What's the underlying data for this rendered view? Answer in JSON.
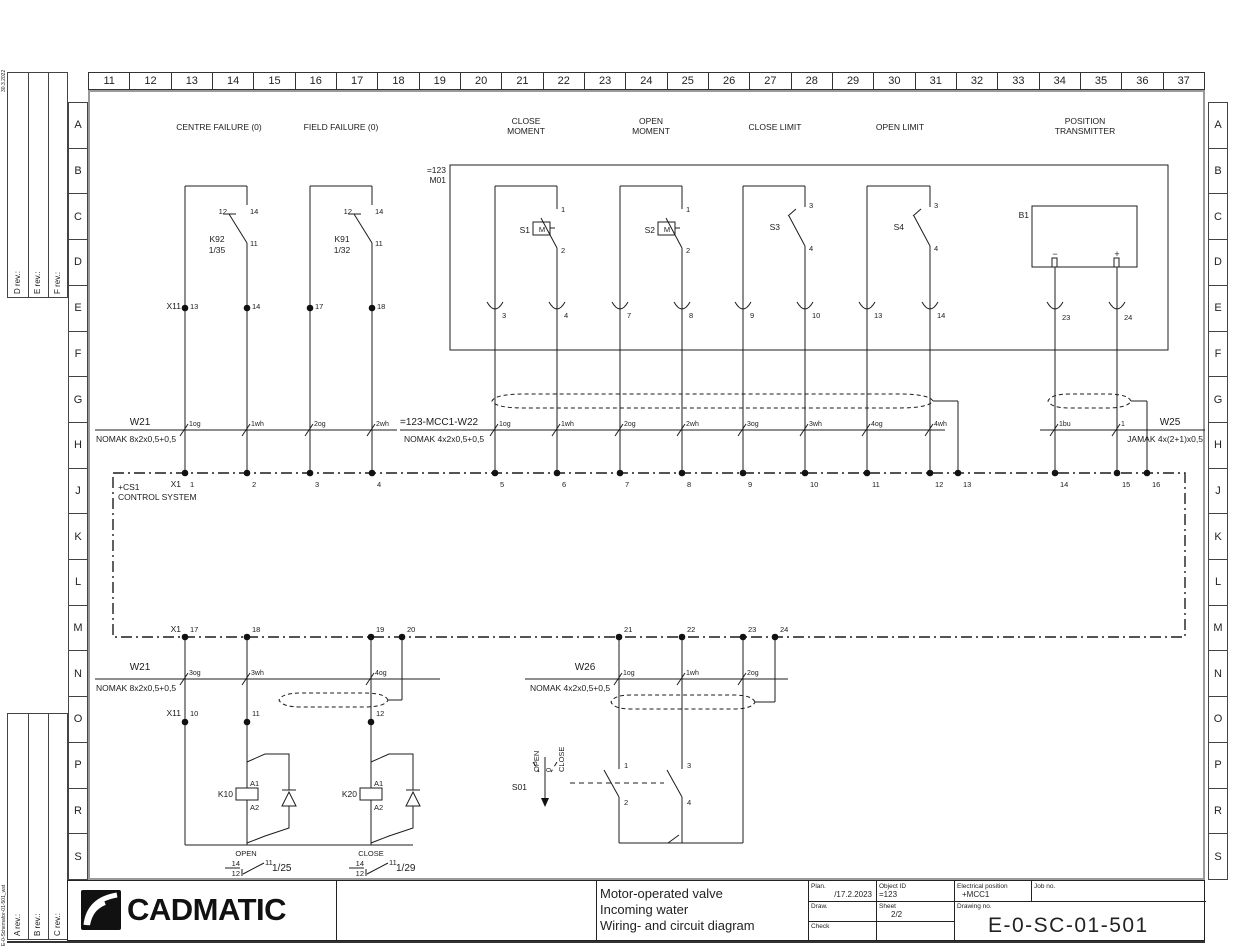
{
  "frame": {
    "ruler_numbers": [
      "11",
      "12",
      "13",
      "14",
      "15",
      "16",
      "17",
      "18",
      "19",
      "20",
      "21",
      "22",
      "23",
      "24",
      "25",
      "26",
      "27",
      "28",
      "29",
      "30",
      "31",
      "32",
      "33",
      "34",
      "35",
      "36",
      "37"
    ],
    "row_letters": [
      "A",
      "B",
      "C",
      "D",
      "E",
      "F",
      "G",
      "H",
      "J",
      "K",
      "L",
      "M",
      "N",
      "O",
      "P",
      "R",
      "S"
    ],
    "rev_labels_top": [
      "D rev.:",
      "E rev.:",
      "F rev.:"
    ],
    "rev_labels_bottom": [
      "A rev.:",
      "B rev.:",
      "C rev.:"
    ],
    "edge_text_top": "30.3.2022",
    "edge_text_bottom": "E-0-Schemafor-01-501_wst"
  },
  "titleblock": {
    "logo_text": "CADMATIC",
    "description": [
      "Motor-operated valve",
      "Incoming water",
      "Wiring- and circuit diagram"
    ],
    "plan_label": "Plan.",
    "plan_value": "/17.2.2023",
    "object_id_label": "Object ID",
    "object_id_value": "=123",
    "elec_pos_label": "Electrical position",
    "elec_pos_value": "+MCC1",
    "job_no_label": "Job no.",
    "draw_label": "Draw.",
    "sheet_label": "Sheet",
    "sheet_value": "2/2",
    "check_label": "Check",
    "drawing_no_label": "Drawing no.",
    "drawing_no_value": "E-0-SC-01-501"
  },
  "geometry": {
    "top_terminals_x": [
      185,
      247,
      310,
      372,
      495,
      557,
      620,
      682,
      743,
      805,
      867,
      930,
      958,
      1055,
      1117,
      1147
    ],
    "top_terminals_y": 473,
    "x11_top_x": [
      185,
      247,
      310,
      372
    ],
    "x11_top_y": 308,
    "bottom_terminals_x": [
      185,
      247,
      371,
      402,
      619,
      682,
      743,
      775
    ],
    "bottom_terminals_y": 637,
    "x11_bottom_x": [
      185,
      247,
      371
    ],
    "x11_bottom_y": 722,
    "hooks_x": [
      495,
      557,
      620,
      682,
      743,
      805,
      867,
      930,
      1055,
      1117
    ],
    "upper_cross_x": [
      185,
      247,
      310,
      372,
      495,
      557,
      620,
      682,
      743,
      805,
      867,
      930,
      1055,
      1117
    ],
    "upper_cross_y": 430,
    "lower_cross_x": [
      185,
      247,
      371,
      619,
      682,
      743
    ],
    "lower_cross_y": 679
  },
  "annotations": [
    {
      "t": "CENTRE FAILURE (0)",
      "x": 219,
      "y": 130,
      "a": "m"
    },
    {
      "t": "FIELD FAILURE (0)",
      "x": 341,
      "y": 130,
      "a": "m"
    },
    {
      "t": "CLOSE",
      "x": 526,
      "y": 124,
      "a": "m"
    },
    {
      "t": "MOMENT",
      "x": 526,
      "y": 134,
      "a": "m"
    },
    {
      "t": "OPEN",
      "x": 651,
      "y": 124,
      "a": "m"
    },
    {
      "t": "MOMENT",
      "x": 651,
      "y": 134,
      "a": "m"
    },
    {
      "t": "CLOSE LIMIT",
      "x": 775,
      "y": 130,
      "a": "m"
    },
    {
      "t": "OPEN LIMIT",
      "x": 900,
      "y": 130,
      "a": "m"
    },
    {
      "t": "POSITION",
      "x": 1085,
      "y": 124,
      "a": "m"
    },
    {
      "t": "TRANSMITTER",
      "x": 1085,
      "y": 134,
      "a": "m"
    },
    {
      "t": "=123",
      "x": 446,
      "y": 173,
      "a": "e"
    },
    {
      "t": "M01",
      "x": 446,
      "y": 183,
      "a": "e"
    },
    {
      "t": "12",
      "x": 227,
      "y": 214,
      "a": "e",
      "s": 7.5
    },
    {
      "t": "14",
      "x": 250,
      "y": 214,
      "s": 7.5
    },
    {
      "t": "K92",
      "x": 217,
      "y": 242,
      "a": "m"
    },
    {
      "t": "1/35",
      "x": 217,
      "y": 253,
      "a": "m"
    },
    {
      "t": "11",
      "x": 250,
      "y": 246,
      "s": 7.5
    },
    {
      "t": "12",
      "x": 352,
      "y": 214,
      "a": "e",
      "s": 7.5
    },
    {
      "t": "14",
      "x": 375,
      "y": 214,
      "s": 7.5
    },
    {
      "t": "K91",
      "x": 342,
      "y": 242,
      "a": "m"
    },
    {
      "t": "1/32",
      "x": 342,
      "y": 253,
      "a": "m"
    },
    {
      "t": "11",
      "x": 375,
      "y": 246,
      "s": 7.5
    },
    {
      "t": "X11",
      "x": 181,
      "y": 309,
      "a": "e"
    },
    {
      "t": "13",
      "x": 190,
      "y": 309,
      "s": 7.5
    },
    {
      "t": "14",
      "x": 252,
      "y": 309,
      "s": 7.5
    },
    {
      "t": "17",
      "x": 315,
      "y": 309,
      "s": 7.5
    },
    {
      "t": "18",
      "x": 377,
      "y": 309,
      "s": 7.5
    },
    {
      "t": "S1",
      "x": 530,
      "y": 233,
      "a": "e"
    },
    {
      "t": "M",
      "x": 542,
      "y": 232,
      "a": "m",
      "s": 7.5
    },
    {
      "t": "1",
      "x": 561,
      "y": 212,
      "s": 7.5
    },
    {
      "t": "2",
      "x": 561,
      "y": 253,
      "s": 7.5
    },
    {
      "t": "S2",
      "x": 655,
      "y": 233,
      "a": "e"
    },
    {
      "t": "M",
      "x": 667,
      "y": 232,
      "a": "m",
      "s": 7.5
    },
    {
      "t": "1",
      "x": 686,
      "y": 212,
      "s": 7.5
    },
    {
      "t": "2",
      "x": 686,
      "y": 253,
      "s": 7.5
    },
    {
      "t": "S3",
      "x": 780,
      "y": 230,
      "a": "e"
    },
    {
      "t": "3",
      "x": 809,
      "y": 208,
      "s": 7.5
    },
    {
      "t": "4",
      "x": 809,
      "y": 251,
      "s": 7.5
    },
    {
      "t": "S4",
      "x": 904,
      "y": 230,
      "a": "e"
    },
    {
      "t": "3",
      "x": 934,
      "y": 208,
      "s": 7.5
    },
    {
      "t": "4",
      "x": 934,
      "y": 251,
      "s": 7.5
    },
    {
      "t": "B1",
      "x": 1029,
      "y": 218,
      "a": "e"
    },
    {
      "t": "−",
      "x": 1055,
      "y": 257,
      "a": "m",
      "s": 9
    },
    {
      "t": "+",
      "x": 1117,
      "y": 257,
      "a": "m",
      "s": 9
    },
    {
      "t": "3",
      "x": 502,
      "y": 318,
      "s": 7.5
    },
    {
      "t": "4",
      "x": 564,
      "y": 318,
      "s": 7.5
    },
    {
      "t": "7",
      "x": 627,
      "y": 318,
      "s": 7.5
    },
    {
      "t": "8",
      "x": 689,
      "y": 318,
      "s": 7.5
    },
    {
      "t": "9",
      "x": 750,
      "y": 318,
      "s": 7.5
    },
    {
      "t": "10",
      "x": 812,
      "y": 318,
      "s": 7.5
    },
    {
      "t": "13",
      "x": 874,
      "y": 318,
      "s": 7.5
    },
    {
      "t": "14",
      "x": 937,
      "y": 318,
      "s": 7.5
    },
    {
      "t": "23",
      "x": 1062,
      "y": 320,
      "s": 7.5
    },
    {
      "t": "24",
      "x": 1124,
      "y": 320,
      "s": 7.5
    },
    {
      "t": "W21",
      "x": 140,
      "y": 425,
      "a": "m",
      "s": 10
    },
    {
      "t": "NOMAK 8x2x0,5+0,5",
      "x": 96,
      "y": 442
    },
    {
      "t": "1og",
      "x": 189,
      "y": 426,
      "s": 7
    },
    {
      "t": "1wh",
      "x": 251,
      "y": 426,
      "s": 7
    },
    {
      "t": "2og",
      "x": 314,
      "y": 426,
      "s": 7
    },
    {
      "t": "2wh",
      "x": 376,
      "y": 426,
      "s": 7
    },
    {
      "t": "=123-MCC1-W22",
      "x": 400,
      "y": 425,
      "s": 10
    },
    {
      "t": "NOMAK 4x2x0,5+0,5",
      "x": 404,
      "y": 442
    },
    {
      "t": "1og",
      "x": 499,
      "y": 426,
      "s": 7
    },
    {
      "t": "1wh",
      "x": 561,
      "y": 426,
      "s": 7
    },
    {
      "t": "2og",
      "x": 624,
      "y": 426,
      "s": 7
    },
    {
      "t": "2wh",
      "x": 686,
      "y": 426,
      "s": 7
    },
    {
      "t": "3og",
      "x": 747,
      "y": 426,
      "s": 7
    },
    {
      "t": "3wh",
      "x": 809,
      "y": 426,
      "s": 7
    },
    {
      "t": "4og",
      "x": 871,
      "y": 426,
      "s": 7
    },
    {
      "t": "4wh",
      "x": 934,
      "y": 426,
      "s": 7
    },
    {
      "t": "W25",
      "x": 1170,
      "y": 425,
      "a": "m",
      "s": 10
    },
    {
      "t": "JAMAK 4x(2+1)x0,5",
      "x": 1203,
      "y": 442,
      "a": "e"
    },
    {
      "t": "1bu",
      "x": 1059,
      "y": 426,
      "s": 7
    },
    {
      "t": "1",
      "x": 1121,
      "y": 426,
      "s": 7
    },
    {
      "t": "X1",
      "x": 181,
      "y": 487,
      "a": "e"
    },
    {
      "t": "1",
      "x": 190,
      "y": 487,
      "s": 7.5
    },
    {
      "t": "2",
      "x": 252,
      "y": 487,
      "s": 7.5
    },
    {
      "t": "3",
      "x": 315,
      "y": 487,
      "s": 7.5
    },
    {
      "t": "4",
      "x": 377,
      "y": 487,
      "s": 7.5
    },
    {
      "t": "5",
      "x": 500,
      "y": 487,
      "s": 7.5
    },
    {
      "t": "6",
      "x": 562,
      "y": 487,
      "s": 7.5
    },
    {
      "t": "7",
      "x": 625,
      "y": 487,
      "s": 7.5
    },
    {
      "t": "8",
      "x": 687,
      "y": 487,
      "s": 7.5
    },
    {
      "t": "9",
      "x": 748,
      "y": 487,
      "s": 7.5
    },
    {
      "t": "10",
      "x": 810,
      "y": 487,
      "s": 7.5
    },
    {
      "t": "11",
      "x": 872,
      "y": 487,
      "s": 7.5
    },
    {
      "t": "12",
      "x": 935,
      "y": 487,
      "s": 7.5
    },
    {
      "t": "13",
      "x": 963,
      "y": 487,
      "s": 7.5
    },
    {
      "t": "14",
      "x": 1060,
      "y": 487,
      "s": 7.5
    },
    {
      "t": "15",
      "x": 1122,
      "y": 487,
      "s": 7.5
    },
    {
      "t": "16",
      "x": 1152,
      "y": 487,
      "s": 7.5
    },
    {
      "t": "+CS1",
      "x": 118,
      "y": 490
    },
    {
      "t": "CONTROL SYSTEM",
      "x": 118,
      "y": 500
    },
    {
      "t": "X1",
      "x": 181,
      "y": 632,
      "a": "e"
    },
    {
      "t": "17",
      "x": 190,
      "y": 632,
      "s": 7.5
    },
    {
      "t": "18",
      "x": 252,
      "y": 632,
      "s": 7.5
    },
    {
      "t": "19",
      "x": 376,
      "y": 632,
      "s": 7.5
    },
    {
      "t": "20",
      "x": 407,
      "y": 632,
      "s": 7.5
    },
    {
      "t": "21",
      "x": 624,
      "y": 632,
      "s": 7.5
    },
    {
      "t": "22",
      "x": 687,
      "y": 632,
      "s": 7.5
    },
    {
      "t": "23",
      "x": 748,
      "y": 632,
      "s": 7.5
    },
    {
      "t": "24",
      "x": 780,
      "y": 632,
      "s": 7.5
    },
    {
      "t": "W21",
      "x": 140,
      "y": 670,
      "a": "m",
      "s": 10
    },
    {
      "t": "NOMAK 8x2x0,5+0,5",
      "x": 96,
      "y": 691
    },
    {
      "t": "3og",
      "x": 189,
      "y": 675,
      "s": 7
    },
    {
      "t": "3wh",
      "x": 251,
      "y": 675,
      "s": 7
    },
    {
      "t": "4og",
      "x": 375,
      "y": 675,
      "s": 7
    },
    {
      "t": "W26",
      "x": 585,
      "y": 670,
      "a": "m",
      "s": 10
    },
    {
      "t": "NOMAK 4x2x0,5+0,5",
      "x": 530,
      "y": 691
    },
    {
      "t": "1og",
      "x": 623,
      "y": 675,
      "s": 7
    },
    {
      "t": "1wh",
      "x": 686,
      "y": 675,
      "s": 7
    },
    {
      "t": "2og",
      "x": 747,
      "y": 675,
      "s": 7
    },
    {
      "t": "X11",
      "x": 181,
      "y": 716,
      "a": "e"
    },
    {
      "t": "10",
      "x": 190,
      "y": 716,
      "s": 7.5
    },
    {
      "t": "11",
      "x": 252,
      "y": 716,
      "s": 7.5
    },
    {
      "t": "12",
      "x": 376,
      "y": 716,
      "s": 7.5
    },
    {
      "t": "A1",
      "x": 250,
      "y": 786,
      "s": 7.5
    },
    {
      "t": "K10",
      "x": 233,
      "y": 797,
      "a": "e"
    },
    {
      "t": "A2",
      "x": 250,
      "y": 810,
      "s": 7.5
    },
    {
      "t": "A1",
      "x": 374,
      "y": 786,
      "s": 7.5
    },
    {
      "t": "K20",
      "x": 357,
      "y": 797,
      "a": "e"
    },
    {
      "t": "A2",
      "x": 374,
      "y": 810,
      "s": 7.5
    },
    {
      "t": "S01",
      "x": 527,
      "y": 790,
      "a": "e"
    },
    {
      "t": "OPEN",
      "x": 539,
      "y": 772,
      "r": 1,
      "s": 7.5
    },
    {
      "t": "0",
      "x": 551,
      "y": 772,
      "r": 1,
      "s": 7.5
    },
    {
      "t": "CLOSE",
      "x": 564,
      "y": 772,
      "r": 1,
      "s": 7.5
    },
    {
      "t": "1",
      "x": 624,
      "y": 768,
      "s": 7.5
    },
    {
      "t": "2",
      "x": 624,
      "y": 805,
      "s": 7.5
    },
    {
      "t": "3",
      "x": 687,
      "y": 768,
      "s": 7.5
    },
    {
      "t": "4",
      "x": 687,
      "y": 805,
      "s": 7.5
    },
    {
      "t": "OPEN",
      "x": 246,
      "y": 856,
      "a": "m",
      "s": 7.5
    },
    {
      "t": "14",
      "x": 240,
      "y": 866,
      "a": "e",
      "s": 7.5
    },
    {
      "t": "12",
      "x": 240,
      "y": 876,
      "a": "e",
      "s": 7.5
    },
    {
      "t": "11",
      "x": 265,
      "y": 865,
      "s": 7.5
    },
    {
      "t": "1/25",
      "x": 272,
      "y": 871,
      "s": 10
    },
    {
      "t": "CLOSE",
      "x": 371,
      "y": 856,
      "a": "m",
      "s": 7.5
    },
    {
      "t": "14",
      "x": 364,
      "y": 866,
      "a": "e",
      "s": 7.5
    },
    {
      "t": "12",
      "x": 364,
      "y": 876,
      "a": "e",
      "s": 7.5
    },
    {
      "t": "11",
      "x": 389,
      "y": 865,
      "s": 7.5
    },
    {
      "t": "1/29",
      "x": 396,
      "y": 871,
      "s": 10
    },
    {
      "t": "30.3.2022",
      "x": 5,
      "y": 92,
      "r": 1,
      "s": 5
    },
    {
      "t": "E-0-Schemafor-01-501_wst",
      "x": 5,
      "y": 946,
      "r": 1,
      "s": 5
    },
    {
      "t": "D rev.:",
      "x": 20,
      "y": 294,
      "r": 1,
      "s": 8
    },
    {
      "t": "E rev.:",
      "x": 40,
      "y": 294,
      "r": 1,
      "s": 8
    },
    {
      "t": "F rev.:",
      "x": 60,
      "y": 294,
      "r": 1,
      "s": 8
    },
    {
      "t": "A rev.:",
      "x": 20,
      "y": 936,
      "r": 1,
      "s": 8
    },
    {
      "t": "B rev.:",
      "x": 40,
      "y": 936,
      "r": 1,
      "s": 8
    },
    {
      "t": "C rev.:",
      "x": 60,
      "y": 936,
      "r": 1,
      "s": 8
    }
  ]
}
